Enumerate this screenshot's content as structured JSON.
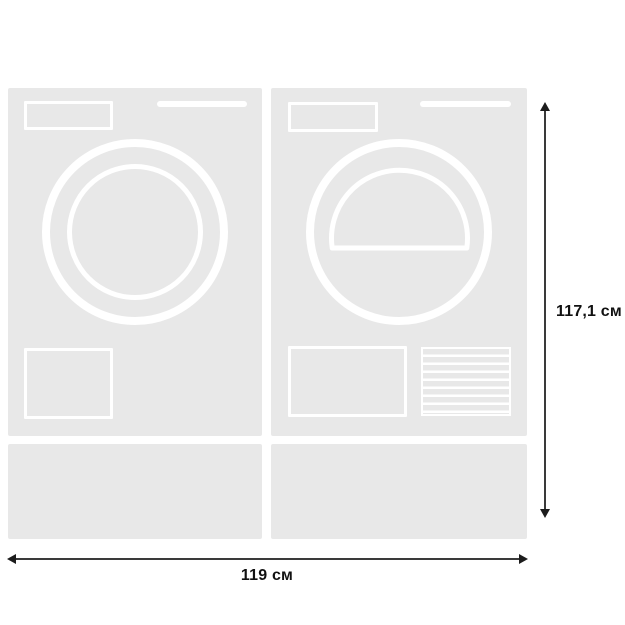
{
  "diagram": {
    "type": "appliance-dimensions",
    "units": [
      {
        "icon": "washing-machine-front-icon"
      },
      {
        "icon": "tumble-dryer-front-icon"
      }
    ],
    "dimensions": {
      "height": {
        "label": "117,1 см"
      },
      "width": {
        "label": "119 см"
      }
    },
    "colors": {
      "background": "#ffffff",
      "appliance_fill": "#e8e8e8",
      "feature_outline": "#ffffff",
      "dimension_line": "#3a3a3a",
      "label_text": "#111111"
    }
  }
}
